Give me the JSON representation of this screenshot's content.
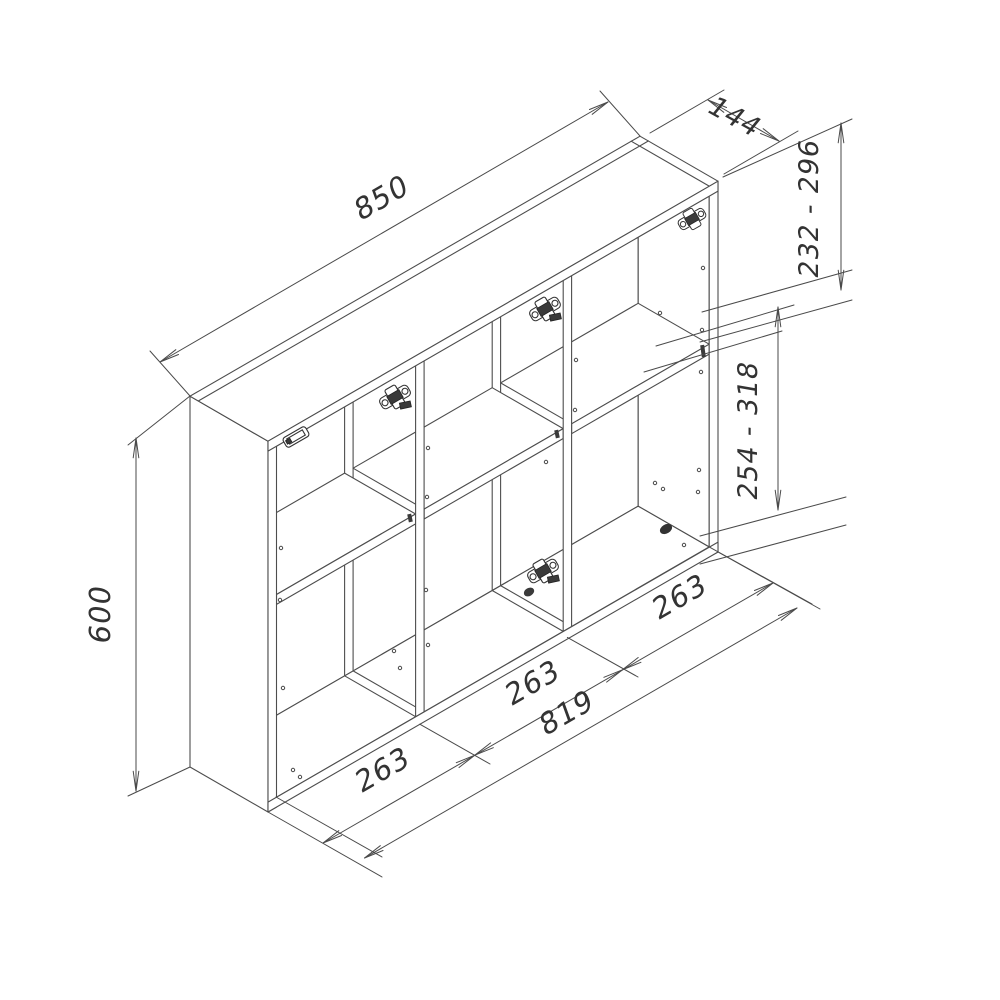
{
  "drawing": {
    "type": "isometric-furniture-dimension-drawing",
    "subject": "three-compartment wall cabinet with shelves and hinge plates",
    "colors": {
      "background": "#ffffff",
      "lines": "#4d4d4d",
      "text": "#333333"
    },
    "dimensions": {
      "overall_width": {
        "label": "850"
      },
      "depth": {
        "label": "144"
      },
      "upper_shelf_range": {
        "label": "232 - 296"
      },
      "lower_shelf_range": {
        "label": "254 - 318"
      },
      "overall_height": {
        "label": "600"
      },
      "compartments": [
        {
          "label": "263"
        },
        {
          "label": "263"
        },
        {
          "label": "263"
        }
      ],
      "interior_width": {
        "label": "819"
      }
    }
  }
}
